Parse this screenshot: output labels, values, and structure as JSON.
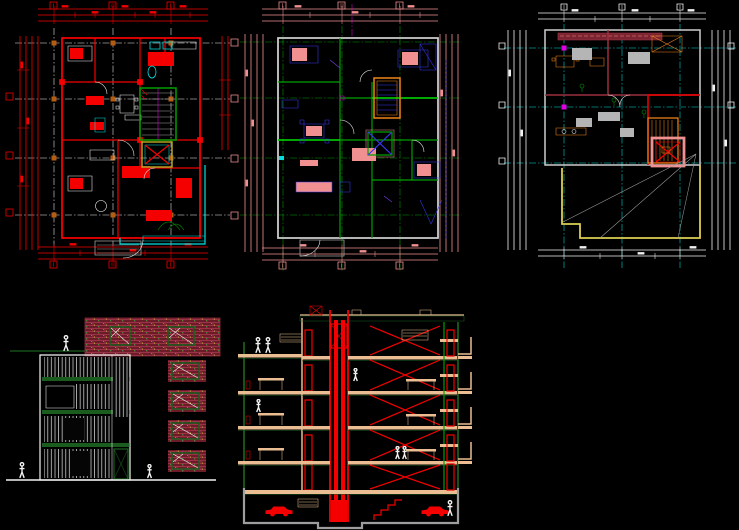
{
  "canvas": {
    "width": 739,
    "height": 530,
    "background": "#000000",
    "app_kind": "CAD drawing sheet"
  },
  "colors": {
    "bg": "#000000",
    "red": "#f40000",
    "maroon": "#9c2f3f",
    "brick": "#6b1c28",
    "brickline": "#a8394e",
    "cyan": "#00e0e0",
    "green": "#00a000",
    "bgreen": "#00d400",
    "dgreen": "#1a5c1e",
    "pink": "#f09090",
    "tan": "#eabe92",
    "blue": "#3838f0",
    "violet": "#8040f0",
    "orange": "#f08418",
    "node": "#b45c12",
    "magenta": "#e400e4",
    "yellow": "#decf52",
    "olive": "#b0a226",
    "white": "#f2f2f2",
    "grey": "#9e9e9e",
    "lgrey": "#cdcdcd",
    "slab_green": "#134a17",
    "furn_grey": "#b5b5b5"
  },
  "drawings": {
    "plan1": {
      "label": "floor-plan",
      "pen_theme": "red / cyan",
      "grid_columns": 3,
      "grid_rows": 4
    },
    "plan2": {
      "label": "floor-plan",
      "pen_theme": "pink / green / blue",
      "grid_columns": 3,
      "grid_rows": 4
    },
    "plan3": {
      "label": "roof-floor-plan",
      "pen_theme": "white / cyan / orange",
      "grid_columns": 3,
      "grid_rows": 3
    },
    "elevation": {
      "label": "elevation",
      "pen_theme": "white / dark-green / brick-hatch"
    },
    "section": {
      "label": "section",
      "pen_theme": "red / dark-green / tan",
      "stories_above_ground": 5,
      "has_basement": true,
      "has_elevator_shaft": true
    }
  }
}
